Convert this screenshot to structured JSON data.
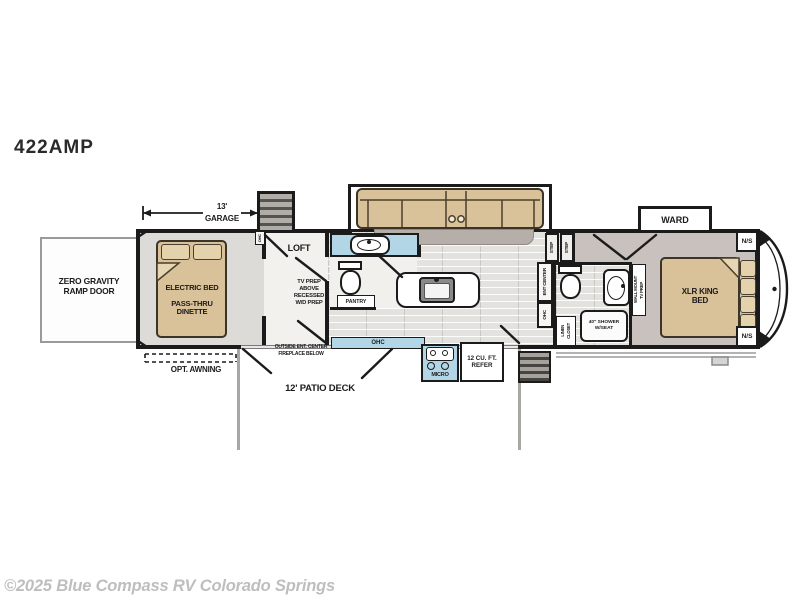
{
  "title": "422AMP",
  "watermark": "©2025 Blue Compass RV Colorado Springs",
  "dimension": {
    "value": "13'",
    "label": "GARAGE"
  },
  "labels": {
    "ramp_door": "ZERO GRAVITY RAMP DOOR",
    "electric_bed": "ELECTRIC BED",
    "dinette": "PASS-THRU DINETTE",
    "loft": "LOFT",
    "tv_prep_lines": [
      "TV PREP",
      "ABOVE",
      "RECESSED",
      "W/D PREP"
    ],
    "pantry": "PANTRY",
    "ohc": "OHC",
    "opt_awning": "OPT. AWNING",
    "patio_deck": "12' PATIO DECK",
    "outside_ent_center": "OUTSIDE ENT. CENTER",
    "fireplace_below": "FIREPLACE BELOW",
    "micro": "MICRO",
    "refer": "12 CU. FT. REFER",
    "step": "STEP",
    "ent_center": "ENT CENTER",
    "linen_1": "LINEN",
    "linen_2": "CLOSET",
    "shower": "40\" SHOWER W/SEAT",
    "wall_mount_1": "WALL MOUNT",
    "wall_mount_2": "TV PREP",
    "king_bed": "XLR KING BED",
    "ward": "WARD",
    "nightstand": "N/S"
  },
  "colors": {
    "accent_blue": "#b3d6e6",
    "furniture_tan": "#d9c299",
    "bedroom_floor": "#c8c1bd",
    "wall": "#1b1b1b",
    "watermark_gray": "#bfbebe"
  }
}
